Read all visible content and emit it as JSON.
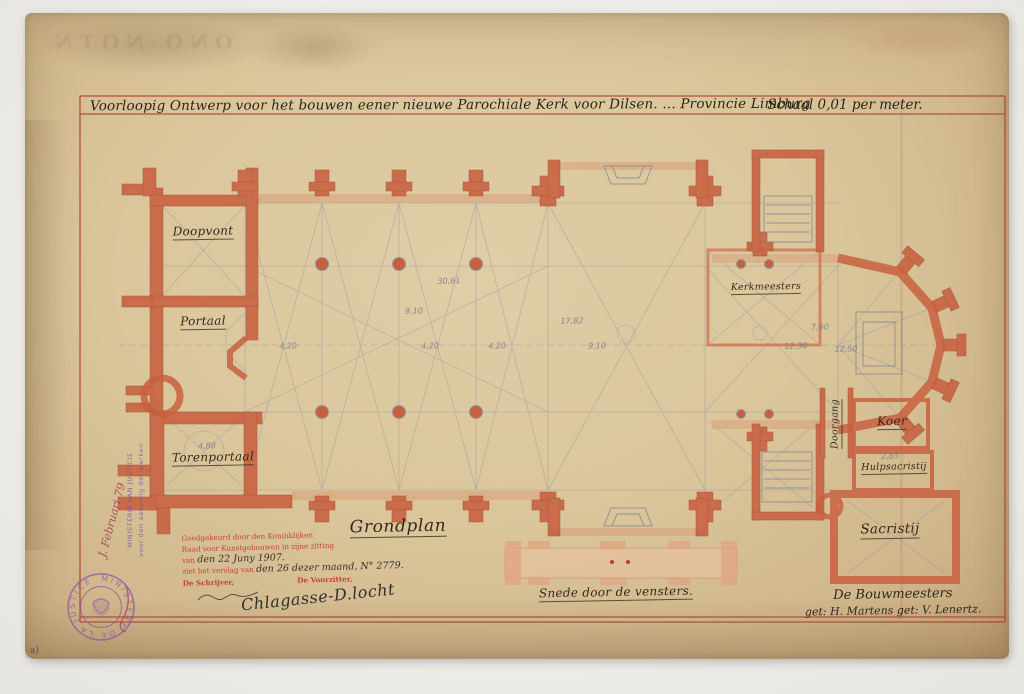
{
  "document": {
    "title": "Voorloopig Ontwerp voor het bouwen eener nieuwe Parochiale Kerk voor Dilsen. ... Provincie Limburg",
    "scale_note": "Schaal 0,01 per meter.",
    "plan_caption": "Grondplan",
    "section_caption": "Snede door de vensters."
  },
  "rooms": {
    "doopvont": "Doopvont",
    "portaal": "Portaal",
    "torenportaal": "Torenportaal",
    "kerkmeesters": "Kerkmeesters",
    "doorgang": "Doorgang",
    "koer": "Koer",
    "hulpsacristij": "Hulpsacristij",
    "sacristij": "Sacristij"
  },
  "dimensions": [
    "30,61",
    "9,10",
    "17,82",
    "9,10",
    "4,20",
    "4,20",
    "4,20",
    "12,50",
    "7,60",
    "12,30",
    "4,88",
    "2,85"
  ],
  "approval_stamp": {
    "line1": "Goedgekeurd door den Koninklijken",
    "line2": "Raad voor Kunstgebouwen in zijne zitting",
    "line3_prefix": "van",
    "line3_hand": "den 22 Juny 1907.",
    "line4_prefix": "ziet het verslag van",
    "line4_hand": "den 26 dezer maand, N° 2779.",
    "clerk": "De Schrijver,",
    "chairman": "De Voorzitter,",
    "chairman_signature": "Chlagasse-D.locht"
  },
  "architects": {
    "line1": "De Bouwmeesters",
    "line2": "get: H. Martens  get: V. Lenertz."
  },
  "ministry_stamp": {
    "ring_text": "MINISTERE DE LA JUSTICE",
    "vertical_line1": "MINISTERIE VAN JUSTICIE",
    "vertical_line2": "voor den aanvang der werken",
    "hand_note": "J. Februari 79"
  },
  "ghost_print": {
    "text": "ONO NOTN"
  },
  "corner_mark": "a)",
  "colors": {
    "paper": "#dbc69c",
    "frame_red": "#b43a2a",
    "wall_red": "#c8603f",
    "pencil": "#8e97a6",
    "stamp_purple": "#8a56a8",
    "stamp_red": "#c23b2e"
  }
}
